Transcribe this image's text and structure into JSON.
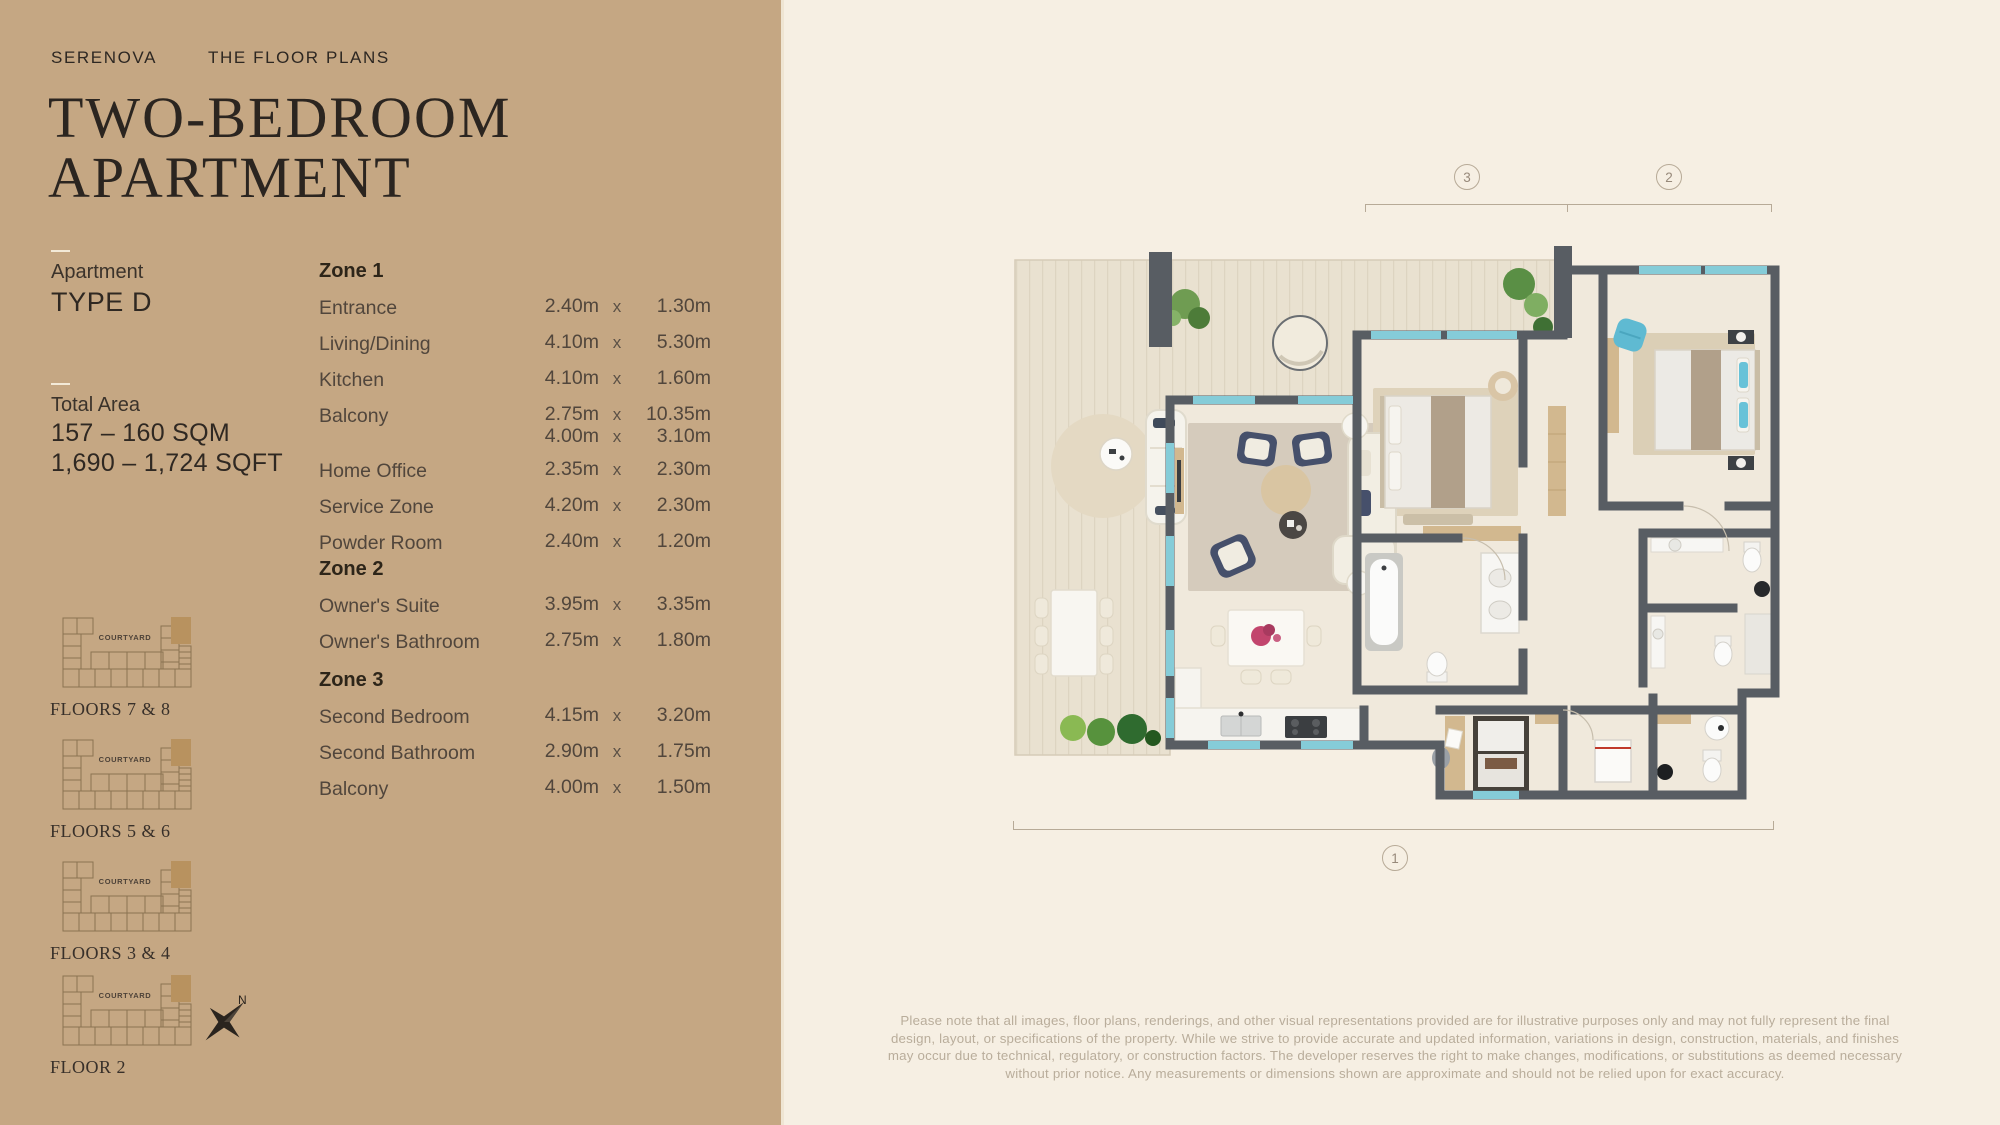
{
  "header": {
    "brand": "SERENOVA",
    "section": "THE FLOOR PLANS"
  },
  "title": {
    "line1": "TWO-BEDROOM",
    "line2": "APARTMENT"
  },
  "apartment": {
    "label": "Apartment",
    "type": "TYPE D"
  },
  "total_area": {
    "label": "Total Area",
    "sqm": "157 – 160 SQM",
    "sqft": "1,690 – 1,724 SQFT"
  },
  "separator": "x",
  "zones": [
    {
      "name": "Zone 1",
      "top": 260,
      "rows": [
        {
          "room": "Entrance",
          "dims": [
            [
              "2.40m",
              "1.30m"
            ]
          ]
        },
        {
          "room": "Living/Dining",
          "dims": [
            [
              "4.10m",
              "5.30m"
            ]
          ]
        },
        {
          "room": "Kitchen",
          "dims": [
            [
              "4.10m",
              "1.60m"
            ]
          ]
        },
        {
          "room": "Balcony",
          "dims": [
            [
              "2.75m",
              "10.35m"
            ],
            [
              "4.00m",
              "3.10m"
            ]
          ]
        },
        {
          "room": "Home Office",
          "dims": [
            [
              "2.35m",
              "2.30m"
            ]
          ]
        },
        {
          "room": "Service Zone",
          "dims": [
            [
              "4.20m",
              "2.30m"
            ]
          ]
        },
        {
          "room": "Powder Room",
          "dims": [
            [
              "2.40m",
              "1.20m"
            ]
          ]
        }
      ]
    },
    {
      "name": "Zone 2",
      "top": 558,
      "rows": [
        {
          "room": "Owner's Suite",
          "dims": [
            [
              "3.95m",
              "3.35m"
            ]
          ]
        },
        {
          "room": "Owner's Bathroom",
          "dims": [
            [
              "2.75m",
              "1.80m"
            ]
          ]
        }
      ]
    },
    {
      "name": "Zone 3",
      "top": 669,
      "rows": [
        {
          "room": "Second Bedroom",
          "dims": [
            [
              "4.15m",
              "3.20m"
            ]
          ]
        },
        {
          "room": "Second Bathroom",
          "dims": [
            [
              "2.90m",
              "1.75m"
            ]
          ]
        },
        {
          "room": "Balcony",
          "dims": [
            [
              "4.00m",
              "1.50m"
            ]
          ]
        }
      ]
    }
  ],
  "floor_diagrams": [
    {
      "label": "FLOORS 7 & 8",
      "courtyard": "COURTYARD",
      "top": 612
    },
    {
      "label": "FLOORS 5 & 6",
      "courtyard": "COURTYARD",
      "top": 734
    },
    {
      "label": "FLOORS 3 & 4",
      "courtyard": "COURTYARD",
      "top": 856
    },
    {
      "label": "FLOOR 2",
      "courtyard": "COURTYARD",
      "top": 970
    }
  ],
  "compass": {
    "label": "N"
  },
  "markers": {
    "m1": "1",
    "m2": "2",
    "m3": "3"
  },
  "disclaimer": "Please note that all images, floor plans, renderings, and other visual representations provided are for illustrative purposes only and may not fully represent the final design, layout, or specifications of the property. While we strive to provide accurate and updated information, variations in design, construction, materials, and finishes may occur due to technical, regulatory, or construction factors. The developer reserves the right to make changes, modifications, or substitutions as deemed necessary without prior notice. Any measurements or dimensions shown are approximate and should not be relied upon for exact accuracy.",
  "colors": {
    "panel_tan": "#c5a783",
    "background_cream": "#f6efe3",
    "wall_gray": "#585d63",
    "window_teal": "#85ccd8",
    "highlight_unit": "#b8925f"
  }
}
